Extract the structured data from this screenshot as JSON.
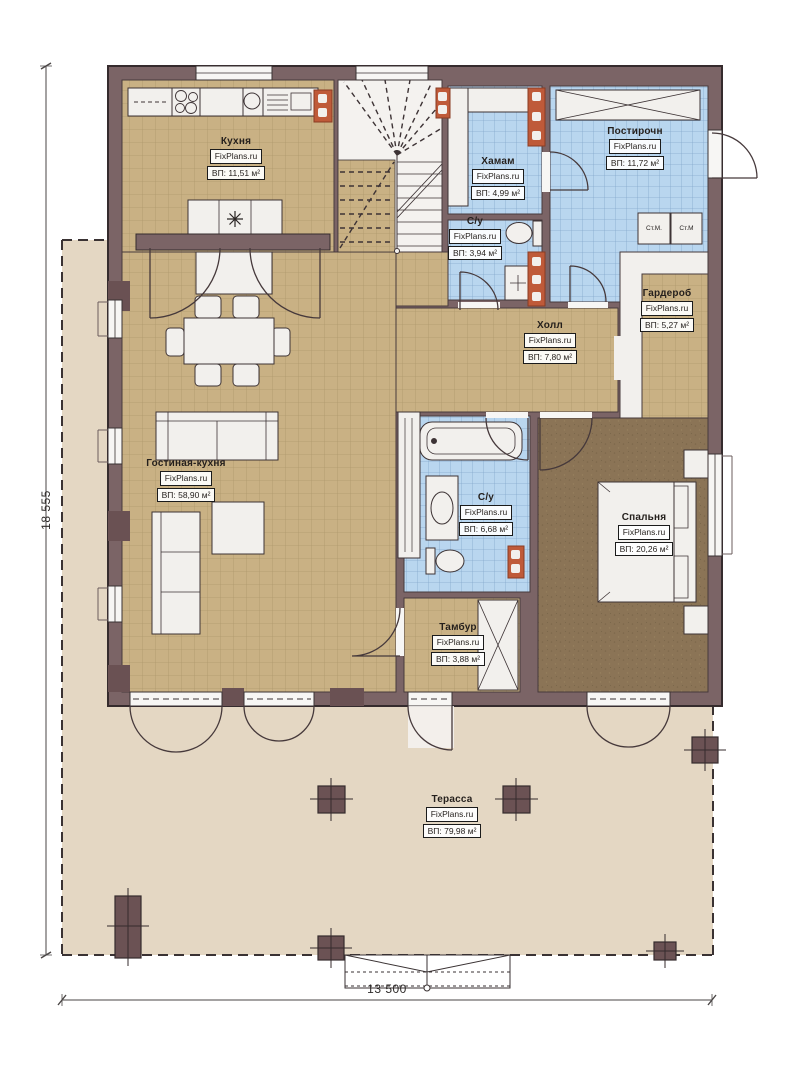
{
  "plan": {
    "site_watermark": "FixPlans.ru",
    "rooms": [
      {
        "id": "kitchen",
        "name": "Кухня",
        "area": "ВП: 11,51 м²"
      },
      {
        "id": "hamam",
        "name": "Хамам",
        "area": "ВП: 4,99 м²"
      },
      {
        "id": "laundry",
        "name": "Постирочн",
        "area": "ВП: 11,72 м²"
      },
      {
        "id": "wc1",
        "name": "С/у",
        "area": "ВП: 3,94 м²"
      },
      {
        "id": "wardrobe",
        "name": "Гардероб",
        "area": "ВП: 5,27 м²"
      },
      {
        "id": "hall",
        "name": "Холл",
        "area": "ВП: 7,80 м²"
      },
      {
        "id": "living",
        "name": "Гостиная-кухня",
        "area": "ВП: 58,90 м²"
      },
      {
        "id": "wc2",
        "name": "С/у",
        "area": "ВП: 6,68 м²"
      },
      {
        "id": "bedroom",
        "name": "Спальня",
        "area": "ВП: 20,26 м²"
      },
      {
        "id": "tambur",
        "name": "Тамбур",
        "area": "ВП: 3,88 м²"
      },
      {
        "id": "terrace",
        "name": "Терасса",
        "area": "ВП: 79,98 м²"
      }
    ],
    "appliances": {
      "washer_left": "Ст.М.",
      "washer_right": "Ст.М"
    },
    "dimensions": {
      "vertical": "18 555",
      "horizontal": "13 500"
    },
    "colors": {
      "wall": "#7b6466",
      "outline": "#352b2d",
      "floor_wood": "#c9b184",
      "floor_tile_blue": "#b9d6ef",
      "floor_bedroom": "#8b7456",
      "terrace": "#e4d7c3",
      "accent_orange": "#bf5a39",
      "fixture_white": "#f2f0ed"
    }
  }
}
